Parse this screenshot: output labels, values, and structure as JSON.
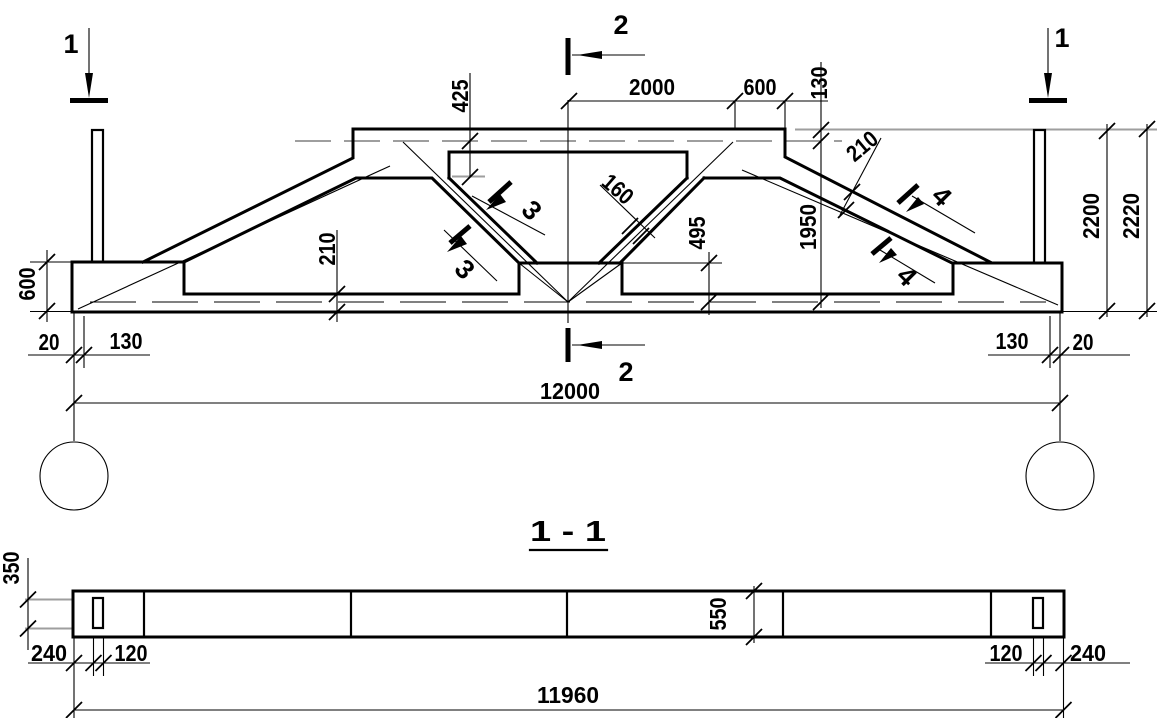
{
  "main_view": {
    "section_marks": {
      "cut1": "1",
      "cut2": "2",
      "cut3": "3",
      "cut4": "4"
    },
    "dims": {
      "top_half_span": "2000",
      "top_end_panel": "600",
      "slab_thickness": "130",
      "chord_depth": "425",
      "truss_inner_height": "1950",
      "height_to_slab": "2200",
      "height_total": "2220",
      "support_height": "600",
      "bottom_chord_depth": "210",
      "diagonal_thickness": "160",
      "node_height": "495",
      "top_chord_thickness": "210",
      "left_end_offset": "20",
      "left_bearing": "130",
      "right_bearing": "130",
      "right_end_offset": "20",
      "span": "12000"
    }
  },
  "section_view": {
    "title": "1 - 1",
    "dims": {
      "flange_width": "350",
      "left_end": "240",
      "left_hole_width": "120",
      "beam_width": "550",
      "right_hole_width": "120",
      "right_end": "240",
      "length": "11960"
    }
  },
  "colors": {
    "line": "#000000",
    "hidden_line": "#9e9e9e",
    "background": "#ffffff"
  }
}
